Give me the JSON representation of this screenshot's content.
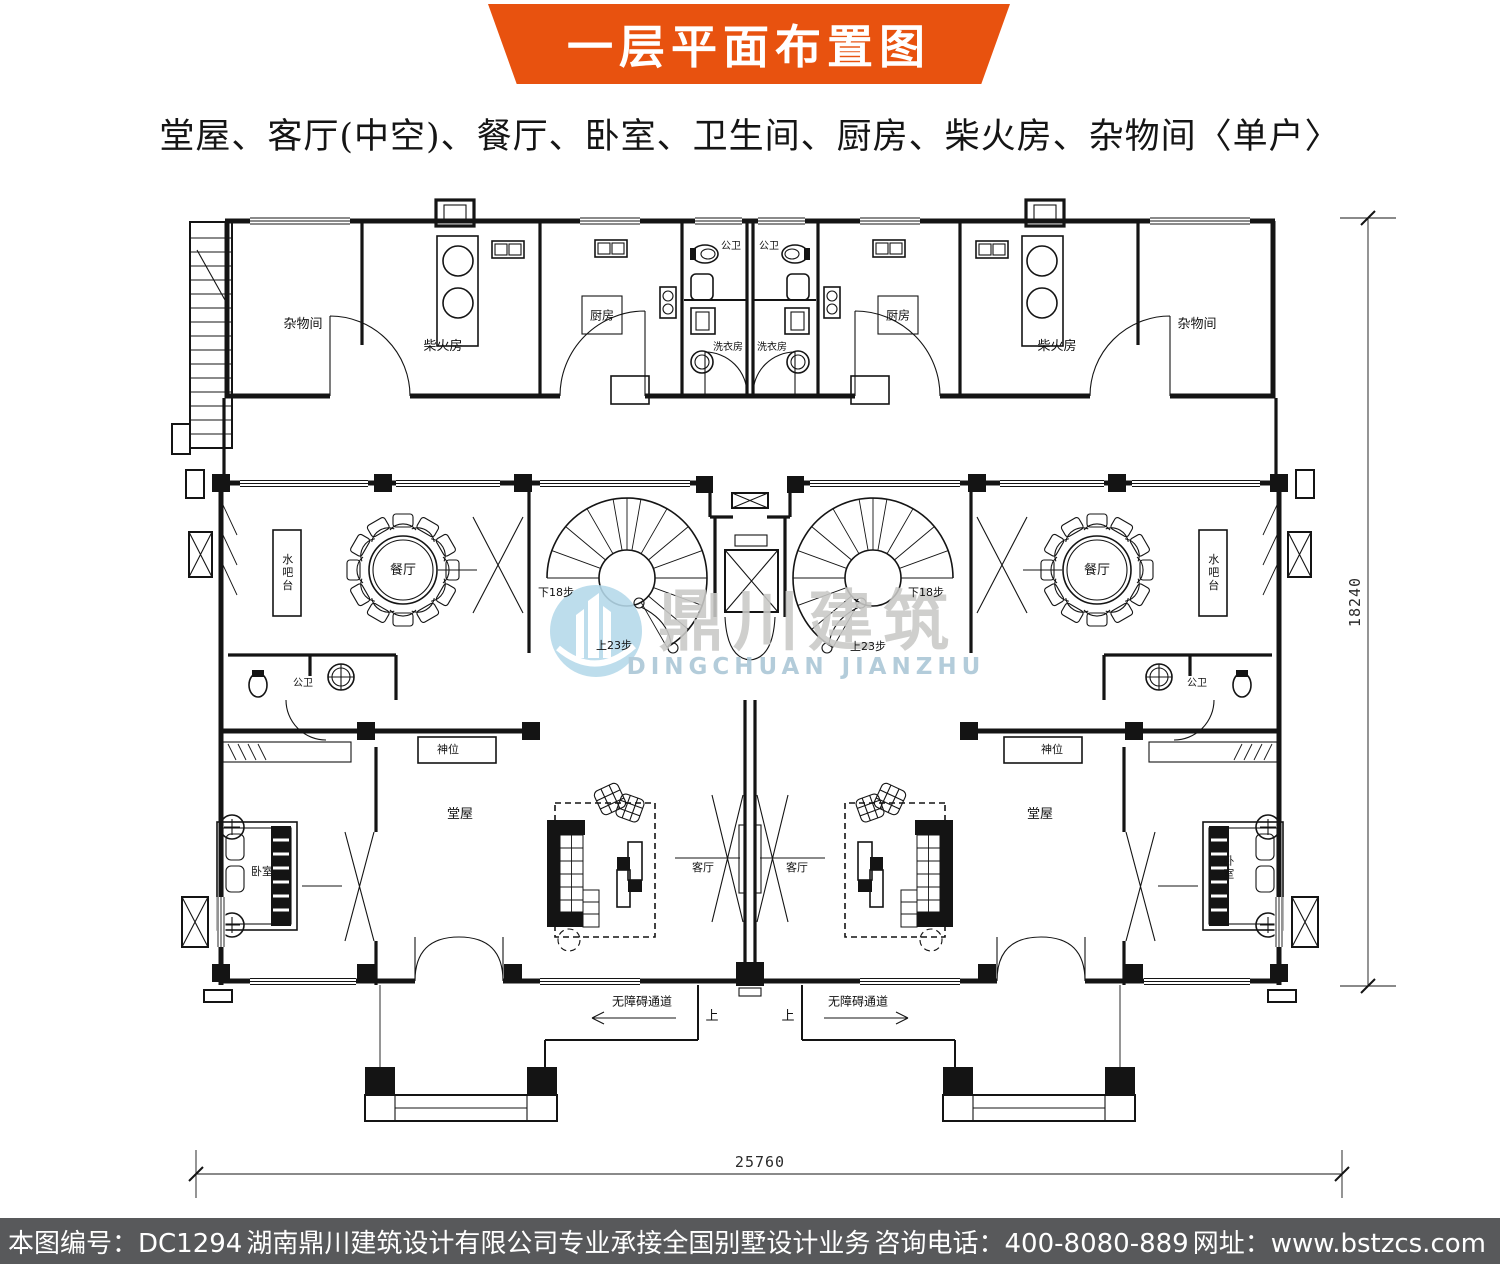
{
  "header": {
    "title": "一层平面布置图",
    "banner_color": "#e8520f"
  },
  "subtitle": "堂屋、客厅(中空)、餐厅、卧室、卫生间、厨房、柴火房、杂物间〈单户〉",
  "watermark": {
    "cn": "鼎川建筑",
    "en": "DINGCHUAN JIANZHU",
    "logo_color": "#b5d9ea",
    "cn_color": "#c9c9c7",
    "en_color": "#a9c6d6"
  },
  "plan": {
    "labels": [
      {
        "name": "label-storage-left",
        "text": "杂物间",
        "x": 303,
        "y": 325,
        "fs": 13
      },
      {
        "name": "label-firewood-left",
        "text": "柴火房",
        "x": 443,
        "y": 347,
        "fs": 13
      },
      {
        "name": "label-kitchen-left",
        "text": "厨房",
        "x": 602,
        "y": 316,
        "fs": 12
      },
      {
        "name": "label-wc-top-left",
        "text": "公卫",
        "x": 731,
        "y": 247,
        "fs": 10
      },
      {
        "name": "label-wc-top-right",
        "text": "公卫",
        "x": 769,
        "y": 247,
        "fs": 10
      },
      {
        "name": "label-laundry-left",
        "text": "洗衣房",
        "x": 728,
        "y": 348,
        "fs": 10
      },
      {
        "name": "label-laundry-right",
        "text": "洗衣房",
        "x": 772,
        "y": 348,
        "fs": 10
      },
      {
        "name": "label-kitchen-right",
        "text": "厨房",
        "x": 898,
        "y": 316,
        "fs": 12
      },
      {
        "name": "label-firewood-right",
        "text": "柴火房",
        "x": 1057,
        "y": 347,
        "fs": 13
      },
      {
        "name": "label-storage-right",
        "text": "杂物间",
        "x": 1197,
        "y": 325,
        "fs": 13
      },
      {
        "name": "label-waterbar-left",
        "text": "水吧台",
        "x": 287,
        "y": 573,
        "fs": 11,
        "cls": "vert"
      },
      {
        "name": "label-dining-left",
        "text": "餐厅",
        "x": 403,
        "y": 571,
        "fs": 13
      },
      {
        "name": "label-stair-down-left",
        "text": "下18步",
        "x": 556,
        "y": 593,
        "fs": 11
      },
      {
        "name": "label-stair-up-left",
        "text": "上23步",
        "x": 614,
        "y": 646,
        "fs": 11
      },
      {
        "name": "label-stair-down-right",
        "text": "下18步",
        "x": 926,
        "y": 593,
        "fs": 11
      },
      {
        "name": "label-stair-up-right",
        "text": "上23步",
        "x": 868,
        "y": 647,
        "fs": 11
      },
      {
        "name": "label-dining-right",
        "text": "餐厅",
        "x": 1097,
        "y": 571,
        "fs": 13
      },
      {
        "name": "label-waterbar-right",
        "text": "水吧台",
        "x": 1213,
        "y": 573,
        "fs": 11,
        "cls": "vert"
      },
      {
        "name": "label-wc-mid-left",
        "text": "公卫",
        "x": 303,
        "y": 684,
        "fs": 10
      },
      {
        "name": "label-wc-mid-right",
        "text": "公卫",
        "x": 1197,
        "y": 684,
        "fs": 10
      },
      {
        "name": "label-shrine-left",
        "text": "神位",
        "x": 448,
        "y": 750,
        "fs": 11
      },
      {
        "name": "label-shrine-right",
        "text": "神位",
        "x": 1052,
        "y": 750,
        "fs": 11
      },
      {
        "name": "label-hall-left",
        "text": "堂屋",
        "x": 460,
        "y": 815,
        "fs": 13
      },
      {
        "name": "label-hall-right",
        "text": "堂屋",
        "x": 1040,
        "y": 815,
        "fs": 13
      },
      {
        "name": "label-bedroom-left",
        "text": "卧室",
        "x": 262,
        "y": 872,
        "fs": 11
      },
      {
        "name": "label-bedroom-right",
        "text": "卧室",
        "x": 1228,
        "y": 868,
        "fs": 11,
        "cls": "vert"
      },
      {
        "name": "label-living-left",
        "text": "客厅",
        "x": 703,
        "y": 868,
        "fs": 11
      },
      {
        "name": "label-living-right",
        "text": "客厅",
        "x": 797,
        "y": 868,
        "fs": 11
      },
      {
        "name": "label-ramp-left",
        "text": "无障碍通道",
        "x": 642,
        "y": 1002,
        "fs": 12
      },
      {
        "name": "label-ramp-right",
        "text": "无障碍通道",
        "x": 858,
        "y": 1002,
        "fs": 12
      },
      {
        "name": "label-up-left",
        "text": "上",
        "x": 712,
        "y": 1017,
        "fs": 13
      },
      {
        "name": "label-up-right",
        "text": "上",
        "x": 788,
        "y": 1017,
        "fs": 13
      },
      {
        "name": "dim-height-label",
        "text": "18240",
        "x": 1356,
        "y": 602,
        "fs": 15,
        "rot": -90,
        "cls": "dim"
      },
      {
        "name": "dim-width-label",
        "text": "25760",
        "x": 760,
        "y": 1163,
        "fs": 15,
        "cls": "dim"
      }
    ]
  },
  "footer": {
    "drawing_no": "本图编号：DC1294",
    "company": "湖南鼎川建筑设计有限公司专业承接全国别墅设计业务",
    "phone": "咨询电话：400-8080-889",
    "website": "网址：www.bstzcs.com",
    "bar_color": "#58595b"
  }
}
